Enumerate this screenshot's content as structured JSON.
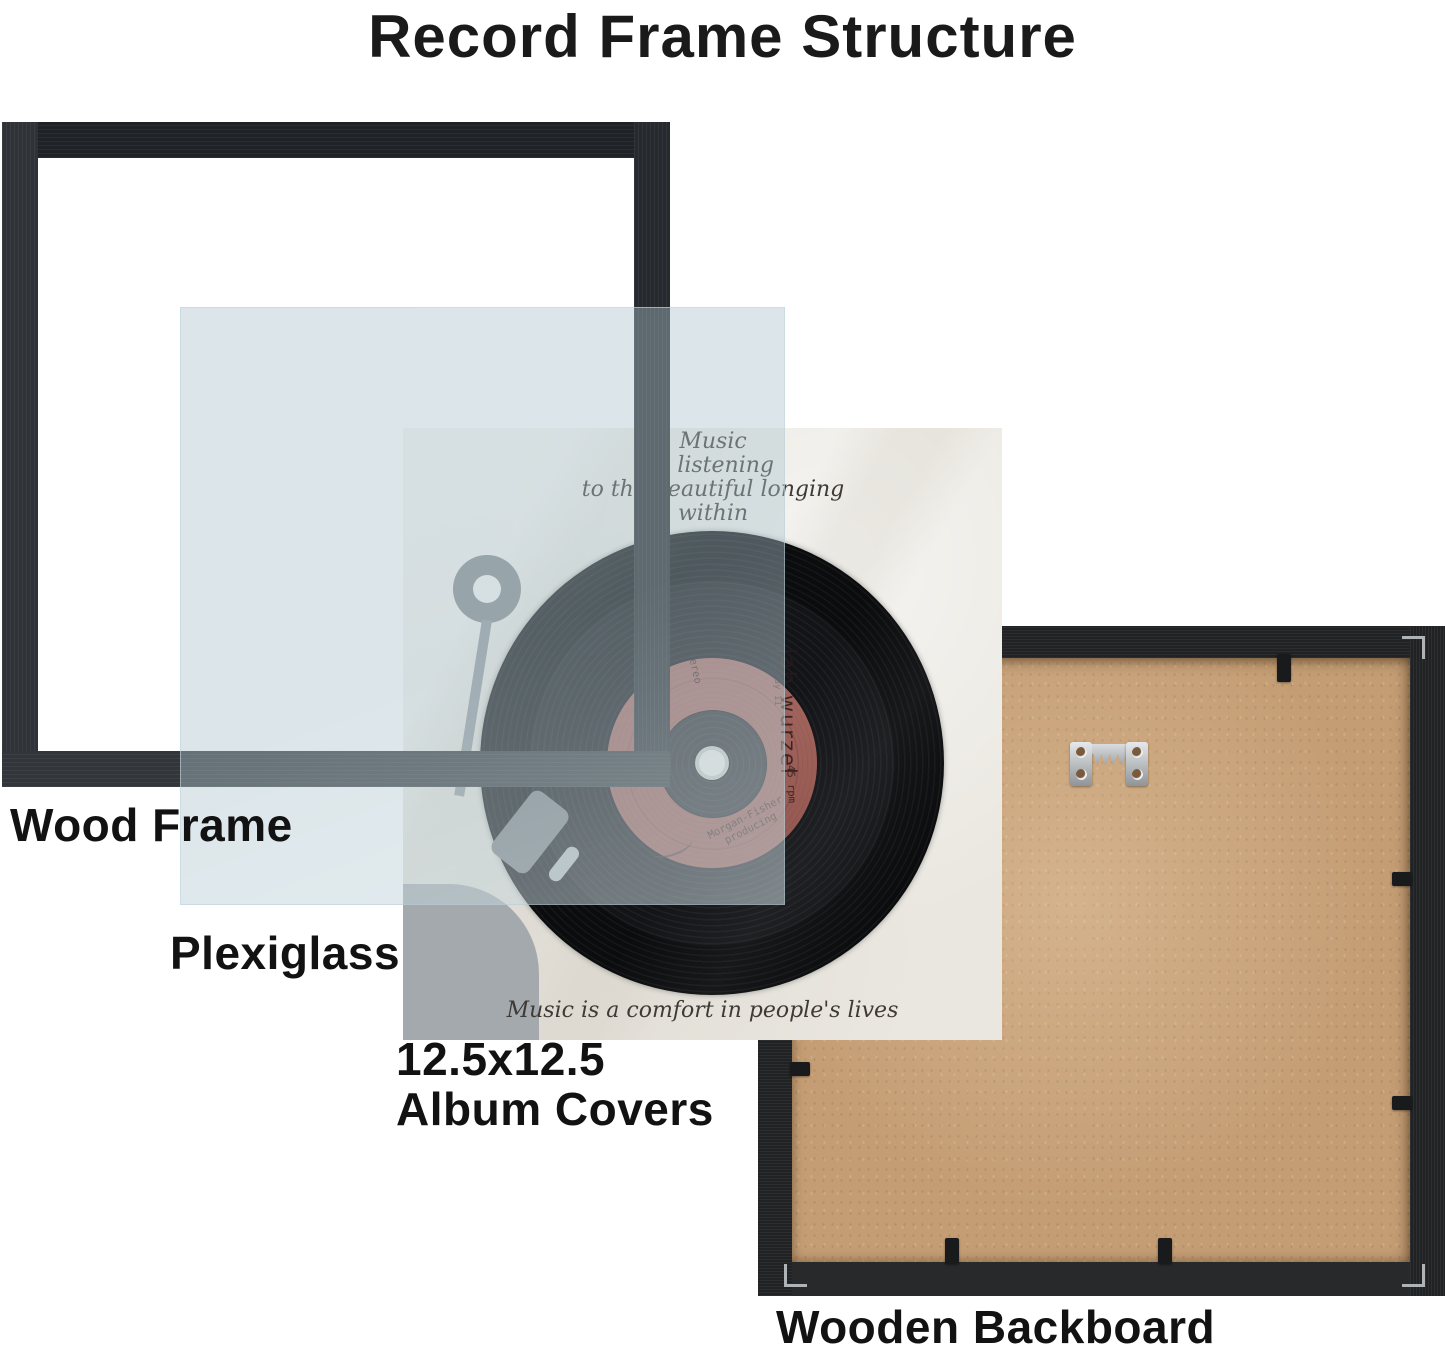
{
  "title": "Record Frame Structure",
  "layers": {
    "wood_frame": {
      "label": "Wood Frame"
    },
    "plexiglass": {
      "label": "Plexiglass"
    },
    "album_covers": {
      "label_line1": "12.5x12.5",
      "label_line2": "Album Covers"
    },
    "backboard": {
      "label": "Wooden Backboard"
    }
  },
  "album_cover": {
    "quote_top": {
      "line1": "Music",
      "line2": "is listening",
      "line3": "to the beautiful longing",
      "line4": "within"
    },
    "quote_bottom": "Music is a comfort in people's lives",
    "record_label": {
      "artist": "jah wurzel",
      "catalog": "Coray 11",
      "format": "stereo",
      "speed": "45 rpm",
      "producer_line1": "Morgan-Fisher",
      "producer_line2": "producing"
    }
  },
  "hardware_icons": {
    "hanger": "sawtooth-hanger-icon",
    "clip": "retention-clip",
    "bracket": "corner-bracket-icon"
  },
  "colors": {
    "frame_black": "#26292d",
    "plexiglass_tint": "#acc4ce",
    "album_background": "#eae7e0",
    "record_black": "#0e0f11",
    "record_label_red": "#9d5c54",
    "backboard_wood": "#c49d74",
    "backboard_frame": "#202224",
    "metal": "#b6babd",
    "text_black": "#151515"
  }
}
